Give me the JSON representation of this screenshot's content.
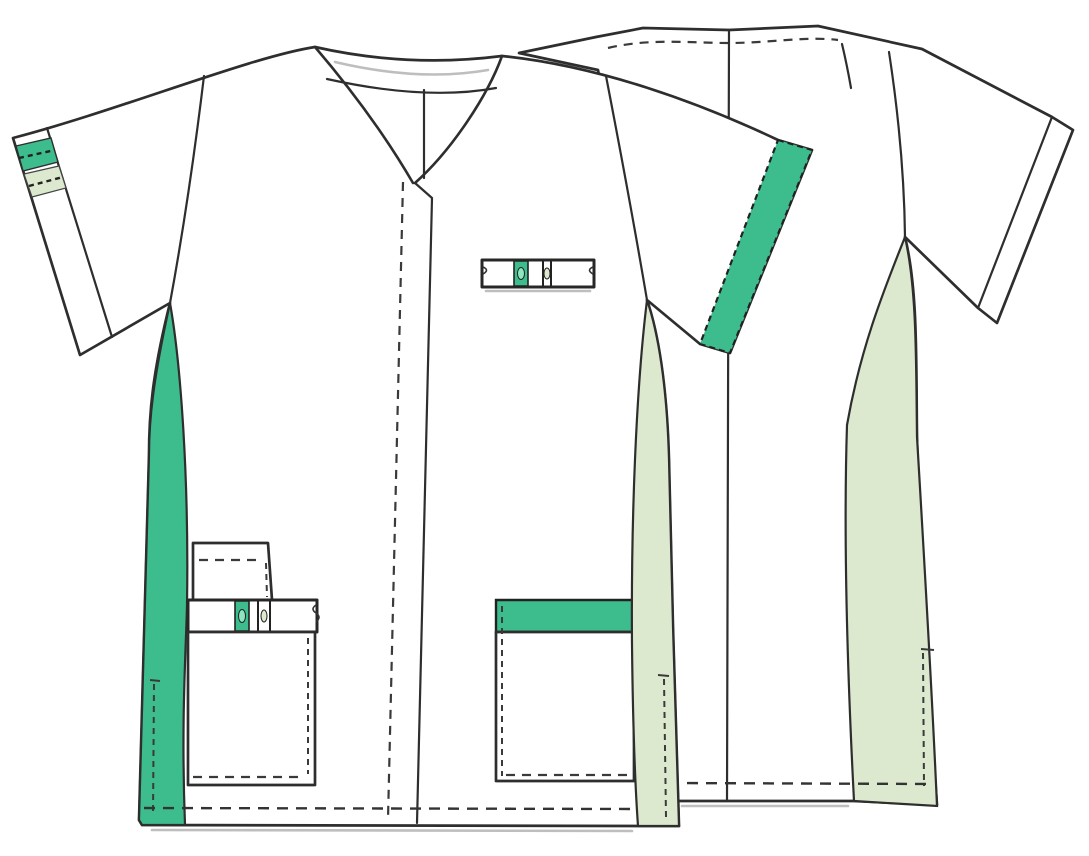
{
  "illustration": {
    "title": "Medical scrub tunic technical flat drawing",
    "views": [
      {
        "name": "front-view",
        "position": "left-foreground"
      },
      {
        "name": "back-view",
        "position": "right-background"
      }
    ],
    "parts": [
      "v-neckline-with-facing",
      "front-placket-with-stitching",
      "left-sleeve-cuff-band-striped",
      "right-sleeve-cuff-band-green",
      "left-side-panel-green",
      "right-side-panel-pale-green",
      "chest-pen-pocket",
      "lower-left-flap-pocket",
      "lower-left-band-pocket",
      "lower-left-patch-pocket",
      "lower-right-pocket-green-band",
      "hem-stitching",
      "side-slit-stitching",
      "back-neck-facing-stitching",
      "center-back-seam",
      "back-side-panel-pale-green",
      "back-sleeve-cuff-band"
    ]
  },
  "colors": {
    "background": "#ffffff",
    "fabric_white": "#ffffff",
    "accent_green": "#3dbd8d",
    "accent_green_light": "#8ce6c0",
    "pale_green": "#dde9cf",
    "outline_dark": "#2e2e2e",
    "stitch_dark": "#3a3a3a",
    "shadow_gray": "#aeaeae"
  }
}
